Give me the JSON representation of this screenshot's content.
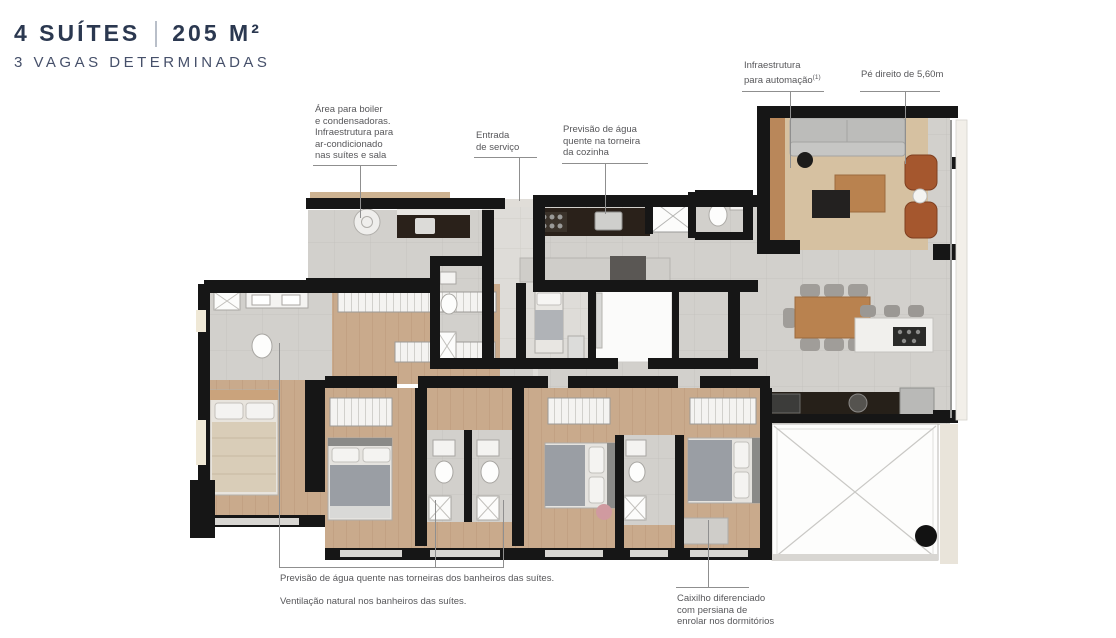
{
  "header": {
    "suites": "4 SUÍTES",
    "area": "205 M²",
    "parking": "3 VAGAS DETERMINADAS"
  },
  "annotations": {
    "boiler": {
      "lines": [
        "Área para boiler",
        "e condensadoras.",
        "Infraestrutura para",
        "ar-condicionado",
        "nas suítes e sala"
      ]
    },
    "service_entrance": {
      "lines": [
        "Entrada",
        "de serviço"
      ]
    },
    "kitchen_hot_water": {
      "lines": [
        "Previsão de água",
        "quente na torneira",
        "da cozinha"
      ]
    },
    "automation": {
      "line1": "Infraestrutura",
      "line2": "para automação",
      "footnote_mark": "(1)"
    },
    "ceiling_height": {
      "text": "Pé direito de 5,60m"
    },
    "suites_hot_water": {
      "text": "Previsão de água quente nas torneiras dos banheiros das suítes."
    },
    "natural_ventilation": {
      "text": "Ventilação natural nos banheiros das suítes."
    },
    "window_frame": {
      "lines": [
        "Caixilho diferenciado",
        "com persiana de",
        "enrolar nos dormitórios"
      ]
    }
  },
  "colors": {
    "title_navy": "#2b3850",
    "annotation_gray": "#57575a",
    "wall_black": "#161616",
    "tile_floor": "#d2d0cc",
    "wood_floor": "#c9aa8c",
    "rug_beige": "#d6c1a1",
    "armchair_brown": "#a5572e",
    "dark_counter": "#2a211a",
    "ottoman_pink": "#d09aa0"
  }
}
